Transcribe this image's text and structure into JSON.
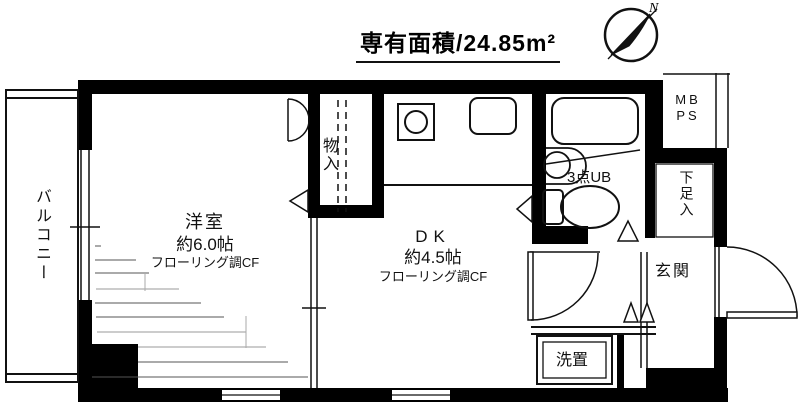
{
  "title": {
    "area_label": "専有面積/24.85m²"
  },
  "compass": {
    "north": "N"
  },
  "rooms": {
    "balcony": {
      "label": "バルコニー"
    },
    "western": {
      "name": "洋室",
      "size": "約6.0帖",
      "floor": "フローリング調CF"
    },
    "closet": {
      "label": "物入"
    },
    "dk": {
      "name": "DK",
      "size": "約4.5帖",
      "floor": "フローリング調CF"
    },
    "unit_bath": {
      "label": "3点UB"
    },
    "meter_box": {
      "line1": "MB",
      "line2": "PS"
    },
    "shoe_box": {
      "label": "下足入"
    },
    "entrance": {
      "label": "玄関"
    },
    "washer": {
      "label": "洗置"
    }
  }
}
